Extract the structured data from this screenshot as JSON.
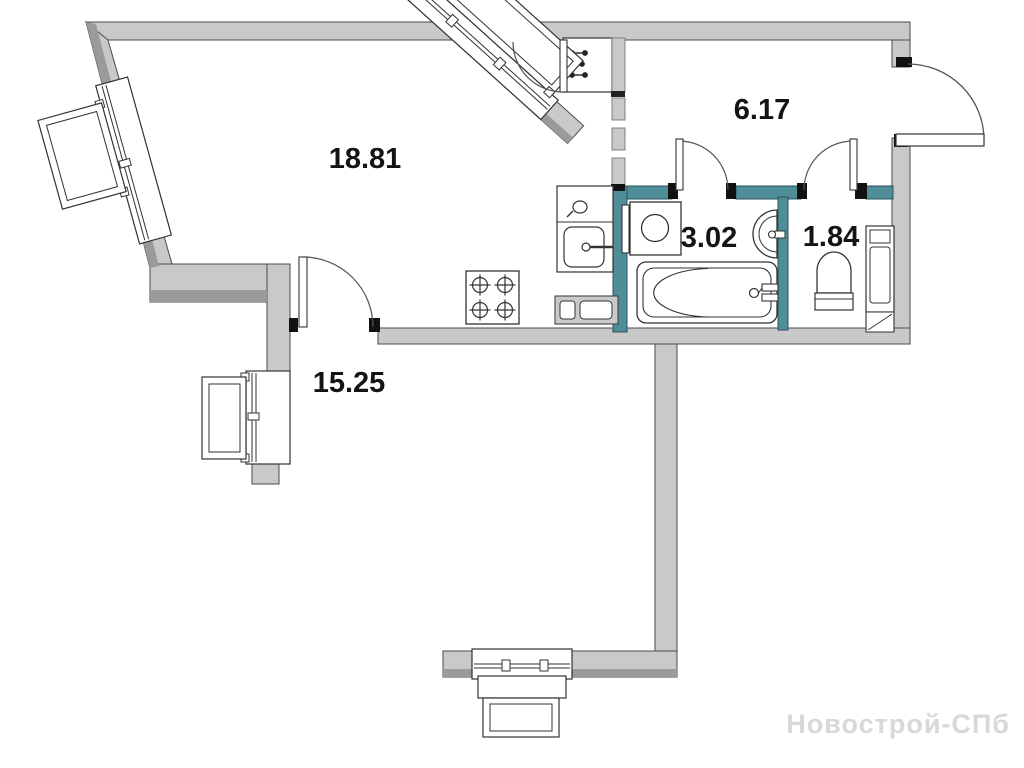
{
  "floorplan": {
    "watermark": "Новострой-СПб",
    "rooms": [
      {
        "id": "kitchen-living",
        "area": "18.81"
      },
      {
        "id": "hallway",
        "area": "6.17"
      },
      {
        "id": "bathroom",
        "area": "3.02"
      },
      {
        "id": "wc",
        "area": "1.84"
      },
      {
        "id": "bedroom",
        "area": "15.25"
      }
    ],
    "fixtures": [
      "stove-icon",
      "kitchen-sink-icon",
      "kitchen-cabinet-icon",
      "washing-machine-icon",
      "bathroom-sink-icon",
      "bathtub-icon",
      "toilet-icon",
      "water-heater-icon",
      "risers-shaft-icon"
    ],
    "colors": {
      "wall": "#c9c9c9",
      "wall_shadow": "#9a9a9a",
      "partition_teal": "#4f8d99",
      "outline": "#4a4a4a",
      "label": "#141414",
      "watermark": "#d8d8d8",
      "background": "#ffffff"
    }
  }
}
